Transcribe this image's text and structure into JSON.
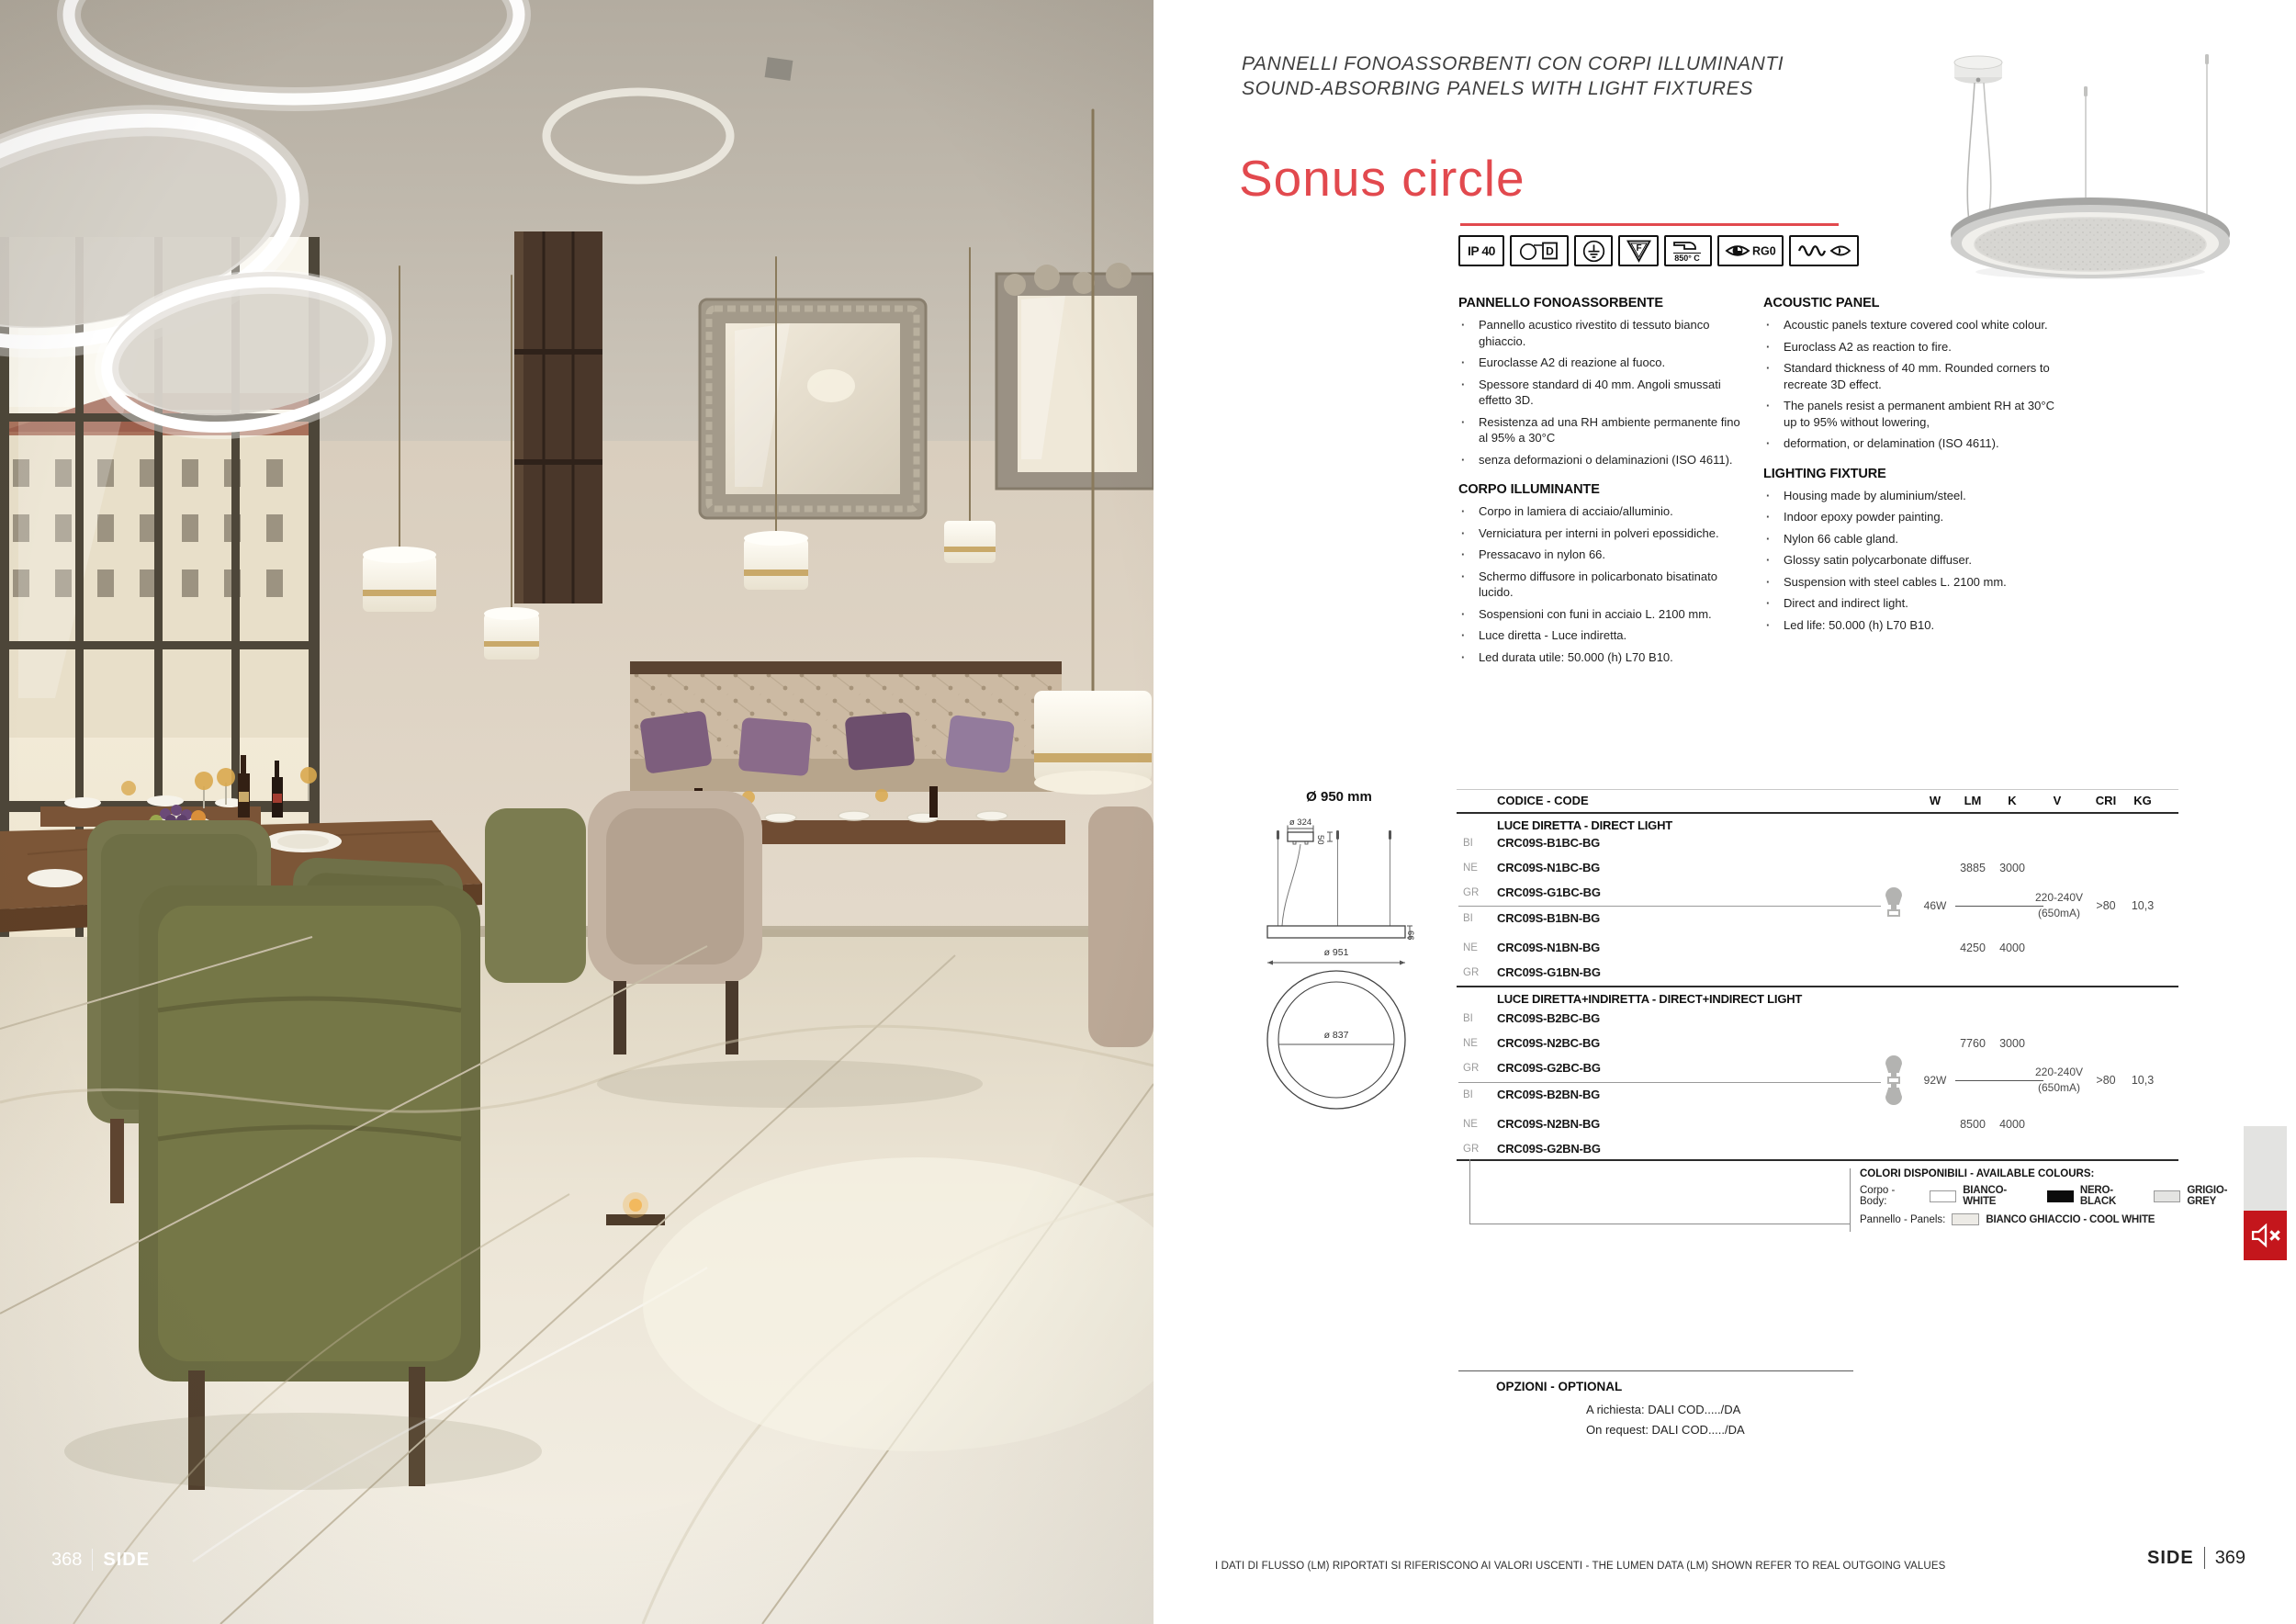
{
  "header": {
    "eyebrow_line1": "PANNELLI FONOASSORBENTI CON CORPI ILLUMINANTI",
    "eyebrow_line2": "SOUND-ABSORBING PANELS WITH LIGHT FIXTURES",
    "product_title": "Sonus circle",
    "accent_color": "#e2494e"
  },
  "icons": {
    "ip_label": "IP 40",
    "lamp_class_label": "D",
    "f_label": "F",
    "glow_wire_label": "850° C",
    "rg_label": "RG0"
  },
  "specs_it": {
    "panel_title": "PANNELLO FONOASSORBENTE",
    "panel_items": [
      "Pannello acustico rivestito di tessuto bianco ghiaccio.",
      "Euroclasse A2 di reazione al fuoco.",
      "Spessore standard di 40 mm. Angoli smussati effetto 3D.",
      "Resistenza ad una RH ambiente permanente fino al 95% a 30°C",
      "senza deformazioni o delaminazioni (ISO 4611)."
    ],
    "body_title": "CORPO ILLUMINANTE",
    "body_items": [
      "Corpo in lamiera di acciaio/alluminio.",
      "Verniciatura per interni in polveri epossidiche.",
      "Pressacavo in nylon 66.",
      "Schermo diffusore in policarbonato bisatinato lucido.",
      "Sospensioni con funi in acciaio L. 2100 mm.",
      "Luce diretta - Luce indiretta.",
      "Led durata utile: 50.000 (h) L70 B10."
    ]
  },
  "specs_en": {
    "panel_title": "ACOUSTIC PANEL",
    "panel_items": [
      "Acoustic panels texture covered cool white colour.",
      "Euroclass A2 as reaction to fire.",
      "Standard thickness of 40 mm. Rounded corners to recreate 3D effect.",
      "The panels resist a permanent ambient RH at 30°C up to 95% without lowering,",
      "deformation, or delamination (ISO 4611)."
    ],
    "fixture_title": "LIGHTING FIXTURE",
    "fixture_items": [
      "Housing made by aluminium/steel.",
      "Indoor epoxy powder painting.",
      "Nylon 66 cable gland.",
      "Glossy satin polycarbonate diffuser.",
      "Suspension with steel cables L. 2100 mm.",
      "Direct and indirect light.",
      "Led life: 50.000 (h) L70 B10."
    ]
  },
  "diagram": {
    "title": "Ø 950 mm",
    "canopy_diameter": "ø 324",
    "canopy_height": "50",
    "panel_diameter": "ø 951",
    "panel_thickness": "66",
    "inner_diameter": "ø 837"
  },
  "table": {
    "code_header": "CODICE - CODE",
    "col_headers": [
      "W",
      "LM",
      "K",
      "V",
      "CRI",
      "KG"
    ],
    "groups": [
      {
        "title": "LUCE DIRETTA - DIRECT LIGHT",
        "rows": [
          {
            "finish": "BI",
            "code": "CRC09S-B1BC-BG",
            "lm": "",
            "k": ""
          },
          {
            "finish": "NE",
            "code": "CRC09S-N1BC-BG",
            "lm": "3885",
            "k": "3000"
          },
          {
            "finish": "GR",
            "code": "CRC09S-G1BC-BG",
            "lm": "",
            "k": ""
          },
          {
            "finish": "BI",
            "code": "CRC09S-B1BN-BG",
            "lm": "",
            "k": ""
          },
          {
            "finish": "NE",
            "code": "CRC09S-N1BN-BG",
            "lm": "4250",
            "k": "4000"
          },
          {
            "finish": "GR",
            "code": "CRC09S-G1BN-BG",
            "lm": "",
            "k": ""
          }
        ],
        "w": "46W",
        "v_line1": "220-240V",
        "v_line2": "(650mA)",
        "cri": ">80",
        "kg": "10,3"
      },
      {
        "title": "LUCE DIRETTA+INDIRETTA - DIRECT+INDIRECT LIGHT",
        "rows": [
          {
            "finish": "BI",
            "code": "CRC09S-B2BC-BG",
            "lm": "",
            "k": ""
          },
          {
            "finish": "NE",
            "code": "CRC09S-N2BC-BG",
            "lm": "7760",
            "k": "3000"
          },
          {
            "finish": "GR",
            "code": "CRC09S-G2BC-BG",
            "lm": "",
            "k": ""
          },
          {
            "finish": "BI",
            "code": "CRC09S-B2BN-BG",
            "lm": "",
            "k": ""
          },
          {
            "finish": "NE",
            "code": "CRC09S-N2BN-BG",
            "lm": "8500",
            "k": "4000"
          },
          {
            "finish": "GR",
            "code": "CRC09S-G2BN-BG",
            "lm": "",
            "k": ""
          }
        ],
        "w": "92W",
        "v_line1": "220-240V",
        "v_line2": "(650mA)",
        "cri": ">80",
        "kg": "10,3"
      }
    ]
  },
  "colours": {
    "title": "COLORI DISPONIBILI - AVAILABLE COLOURS:",
    "body_label": "Corpo - Body:",
    "body_white": "BIANCO- WHITE",
    "body_black": "NERO-BLACK",
    "body_grey": "GRIGIO-GREY",
    "panel_label": "Pannello - Panels:",
    "panel_white": "BIANCO GHIACCIO - COOL WHITE",
    "swatch_white": "#ffffff",
    "swatch_black": "#0c0c0c",
    "swatch_grey": "#e4e4e2",
    "swatch_cool_white": "#edebe6"
  },
  "options": {
    "title": "OPZIONI - OPTIONAL",
    "line_it": "A richiesta: DALI COD...../DA",
    "line_en": "On request: DALI COD...../DA"
  },
  "footer": {
    "note": "I DATI DI FLUSSO (LM) RIPORTATI SI RIFERISCONO AI VALORI USCENTI - THE LUMEN DATA (LM) SHOWN REFER TO REAL OUTGOING VALUES",
    "left_page_number": "368",
    "right_page_number": "369",
    "series_left": "SIDE",
    "series_right": "SIDE"
  },
  "mute_icon_color": "#c4161c"
}
